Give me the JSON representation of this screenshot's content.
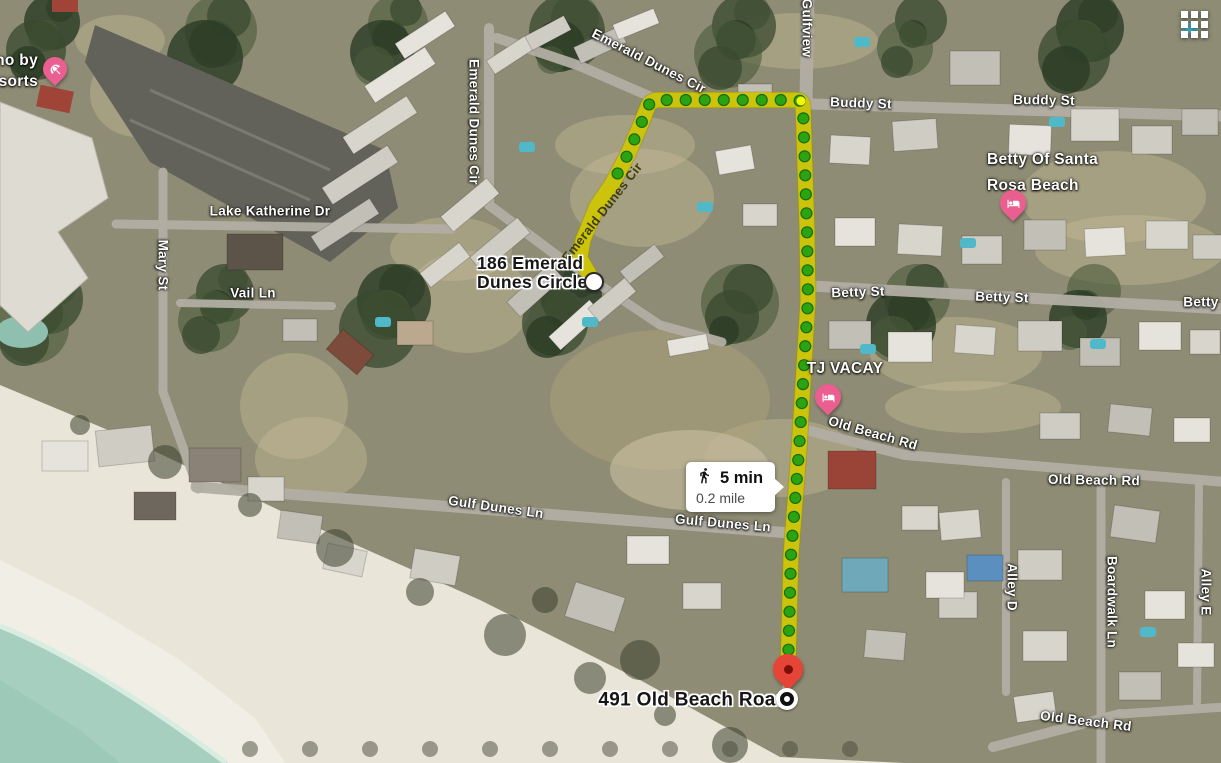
{
  "map": {
    "type": "satellite",
    "description": "aerial map with walking route from 186 Emerald Dunes Circle to 491 Old Beach Road"
  },
  "ui": {
    "grid_icon": "apps-grid",
    "route_color": "#d2c900",
    "walk_dot_color": "#2ca313",
    "destination_pin_color": "#e74438",
    "lodging_pin_color": "#ea5f8f"
  },
  "route_info": {
    "mode": "walking",
    "mode_icon": "walking-person",
    "duration": "5 min",
    "distance": "0.2 mile"
  },
  "endpoints": {
    "origin": {
      "line1": "186 Emerald",
      "line2": "Dunes Circle",
      "marker": "white-circle"
    },
    "destination": {
      "label": "491 Old Beach Road",
      "marker": "red-pin-with-target-circle"
    }
  },
  "street_labels": {
    "emerald_dunes_cir_top": "Emerald Dunes Cir",
    "emerald_dunes_cir_left": "Emerald Dunes Cir",
    "emerald_dunes_cir_route": "Emerald Dunes Cir",
    "gulfview": "Gulfview",
    "buddy_st_w": "Buddy St",
    "buddy_st_e": "Buddy St",
    "betty_st_w": "Betty St",
    "betty_st_mid": "Betty St",
    "betty_st_e": "Betty St",
    "lake_katherine_dr": "Lake Katherine Dr",
    "mary_st": "Mary St",
    "vail_ln": "Vail Ln",
    "gulf_dunes_ln_w": "Gulf Dunes Ln",
    "gulf_dunes_ln_e": "Gulf Dunes Ln",
    "old_beach_rd_curve": "Old Beach Rd",
    "old_beach_rd_e": "Old Beach Rd",
    "old_beach_rd_s": "Old Beach Rd",
    "alley_d": "Alley D",
    "boardwalk_ln": "Boardwalk Ln",
    "alley_e": "Alley E"
  },
  "place_labels": {
    "resort_truncated_line1": "no by",
    "resort_truncated_line2": "sorts",
    "betty_of_santa_line1": "Betty Of Santa",
    "betty_of_santa_line2": "Rosa Beach",
    "tj_vacay": "TJ VACAY"
  }
}
